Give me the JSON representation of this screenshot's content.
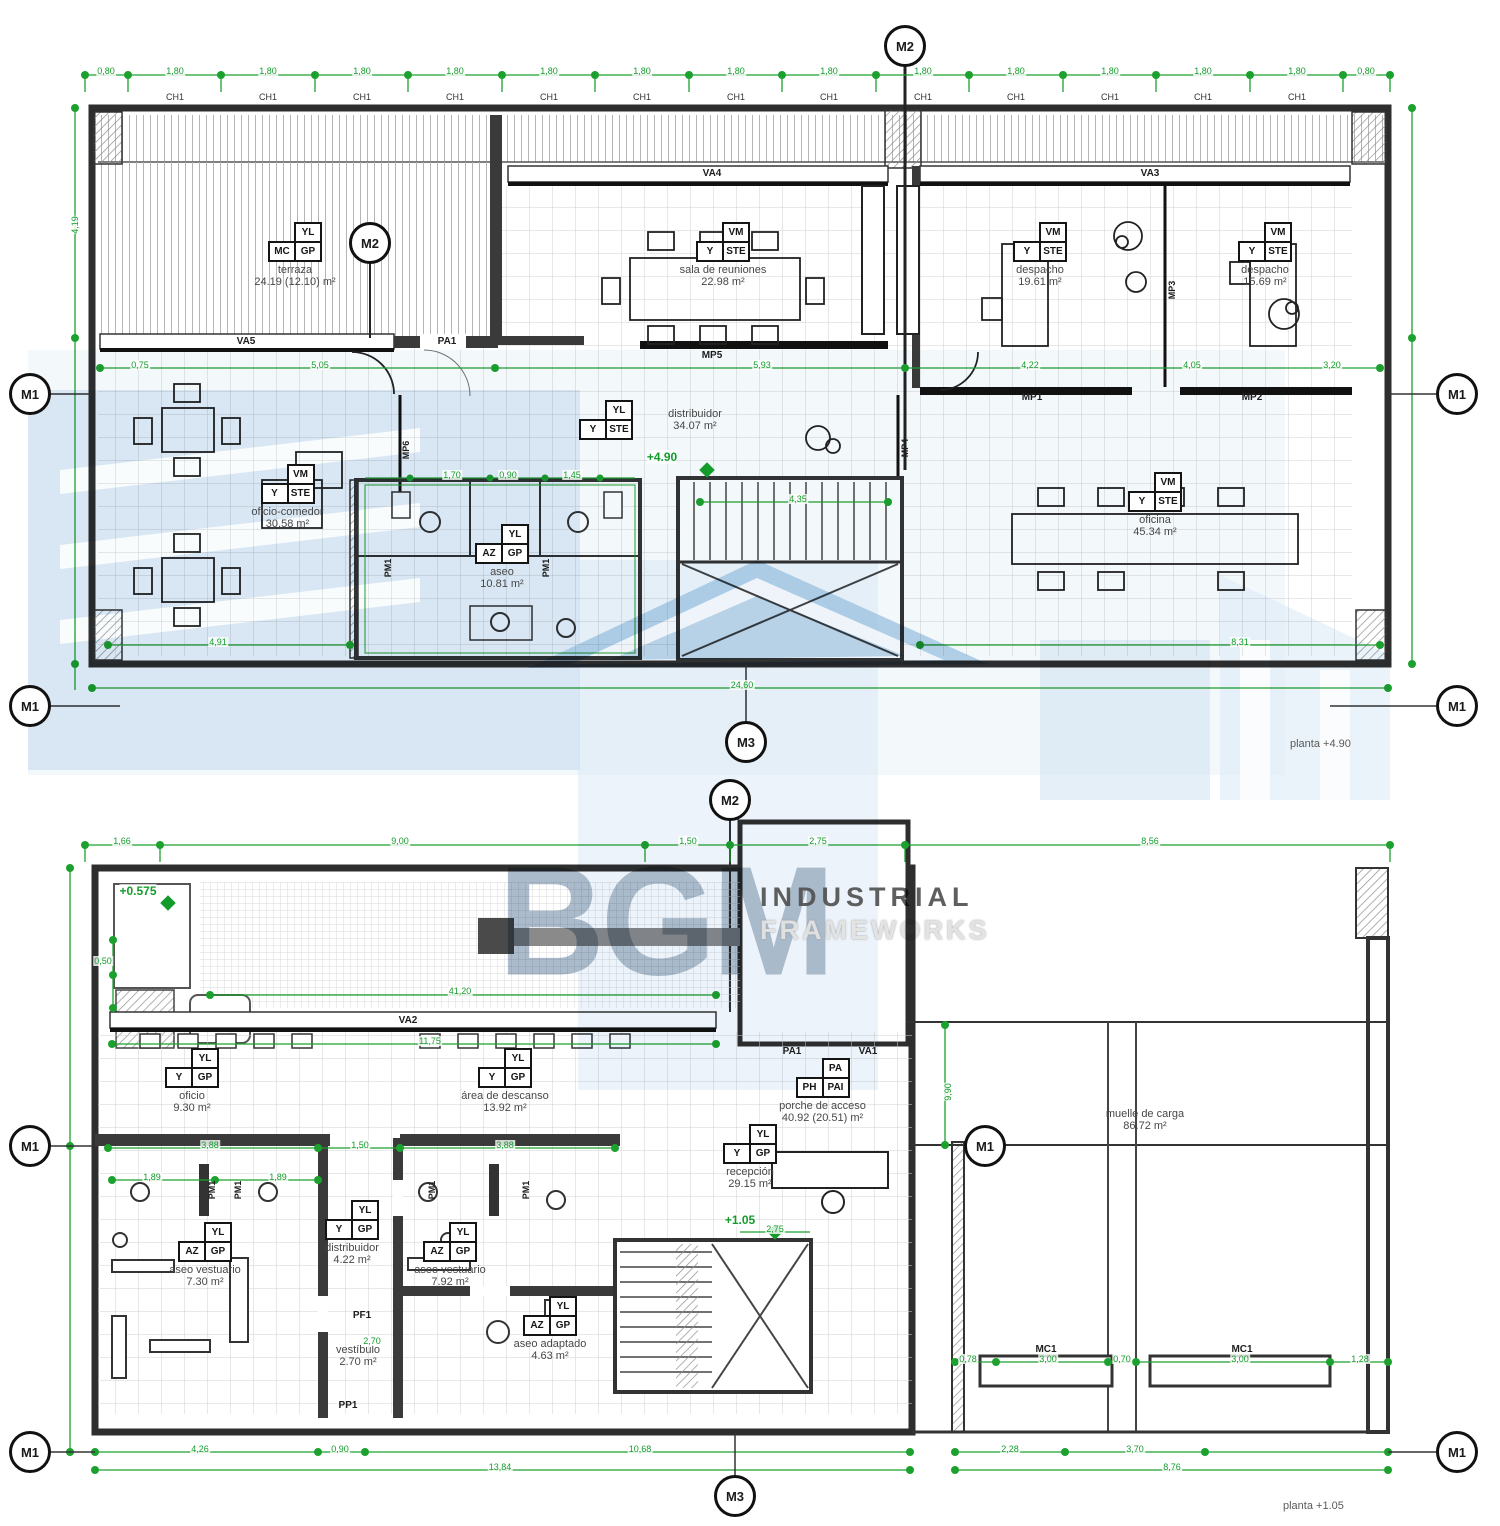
{
  "watermark": {
    "brand": "BGM",
    "tag1": "INDUSTRIAL",
    "tag2": "FRAMEWORKS"
  },
  "markers": {
    "m1": "M1",
    "m2": "M2",
    "m3": "M3"
  },
  "captions": {
    "upper": "planta +4.90",
    "lower": "planta +1.05"
  },
  "levels": {
    "upper": "+4.90",
    "lower": "+1.05",
    "dock": "+0.575"
  },
  "upper": {
    "rooms": [
      {
        "name": "terraza",
        "area": "24.19 (12.10) m²",
        "c_top": "YL",
        "c_l": "MC",
        "c_r": "GP"
      },
      {
        "name": "sala de reuniones",
        "area": "22.98 m²",
        "c_top": "VM",
        "c_l": "Y",
        "c_r": "STE"
      },
      {
        "name": "despacho",
        "area": "19.61 m²",
        "c_top": "VM",
        "c_l": "Y",
        "c_r": "STE"
      },
      {
        "name": "despacho",
        "area": "15.69 m²",
        "c_top": "VM",
        "c_l": "Y",
        "c_r": "STE"
      },
      {
        "name": "distribuidor",
        "area": "34.07 m²",
        "c_top": "YL",
        "c_l": "Y",
        "c_r": "STE"
      },
      {
        "name": "oficio-comedor",
        "area": "30.58 m²",
        "c_top": "VM",
        "c_l": "Y",
        "c_r": "STE"
      },
      {
        "name": "aseo",
        "area": "10.81 m²",
        "c_top": "YL",
        "c_l": "AZ",
        "c_r": "GP"
      },
      {
        "name": "oficina",
        "area": "45.34 m²",
        "c_top": "VM",
        "c_l": "Y",
        "c_r": "STE"
      }
    ],
    "tags": {
      "va4": "VA4",
      "va3": "VA3",
      "va5": "VA5",
      "pa1": "PA1",
      "mp1": "MP1",
      "mp2": "MP2",
      "mp3": "MP3",
      "mp4": "MP4",
      "mp5": "MP5",
      "mp6": "MP6",
      "pm1": "PM1",
      "ch1": "CH1"
    }
  },
  "lower": {
    "rooms": [
      {
        "name": "oficio",
        "area": "9.30 m²",
        "c_top": "YL",
        "c_l": "Y",
        "c_r": "GP"
      },
      {
        "name": "área de descanso",
        "area": "13.92 m²",
        "c_top": "YL",
        "c_l": "Y",
        "c_r": "GP"
      },
      {
        "name": "porche de acceso",
        "area": "40.92 (20.51) m²",
        "c_top": "PA",
        "c_l": "PH",
        "c_r": "PAI"
      },
      {
        "name": "recepción",
        "area": "29.15 m²",
        "c_top": "YL",
        "c_l": "Y",
        "c_r": "GP"
      },
      {
        "name": "aseo vestuario",
        "area": "7.30 m²",
        "c_top": "YL",
        "c_l": "AZ",
        "c_r": "GP"
      },
      {
        "name": "distribuidor",
        "area": "4.22 m²",
        "c_top": "YL",
        "c_l": "Y",
        "c_r": "GP"
      },
      {
        "name": "aseo vestuario",
        "area": "7.92 m²",
        "c_top": "YL",
        "c_l": "AZ",
        "c_r": "GP"
      },
      {
        "name": "vestíbulo",
        "area": "2.70 m²"
      },
      {
        "name": "aseo adaptado",
        "area": "4.63 m²",
        "c_top": "YL",
        "c_l": "AZ",
        "c_r": "GP"
      },
      {
        "name": "muelle de carga",
        "area": "86.72 m²"
      }
    ],
    "tags": {
      "va2": "VA2",
      "va1": "VA1",
      "pa1": "PA1",
      "pf1": "PF1",
      "pp1": "PP1",
      "pm1": "PM1",
      "mc1": "MC1"
    }
  },
  "dims": {
    "t08": "0,80",
    "t18": "1,80",
    "d2460": "24,60",
    "d419": "4,19",
    "d075": "0,75",
    "d505": "5,05",
    "d593": "5,93",
    "d422": "4,22",
    "d405": "4,05",
    "d320": "3,20",
    "d435": "4,35",
    "d491": "4,91",
    "d831": "8,31",
    "d170": "1,70",
    "d090": "0,90",
    "d145": "1,45",
    "d166": "1,66",
    "d900": "9,00",
    "d150": "1,50",
    "d275": "2,75",
    "d856": "8,56",
    "d4120": "41,20",
    "d1175": "11,75",
    "d388": "3,88",
    "d189": "1,89",
    "d990": "9,90",
    "d050": "0,50",
    "d426": "4,26",
    "d1068": "10,68",
    "d1384": "13,84",
    "d228": "2,28",
    "d370": "3,70",
    "d876": "8,76",
    "d078": "0,78",
    "d300": "3,00",
    "d070": "0,70",
    "d128": "1,28",
    "d270": "2,70"
  }
}
